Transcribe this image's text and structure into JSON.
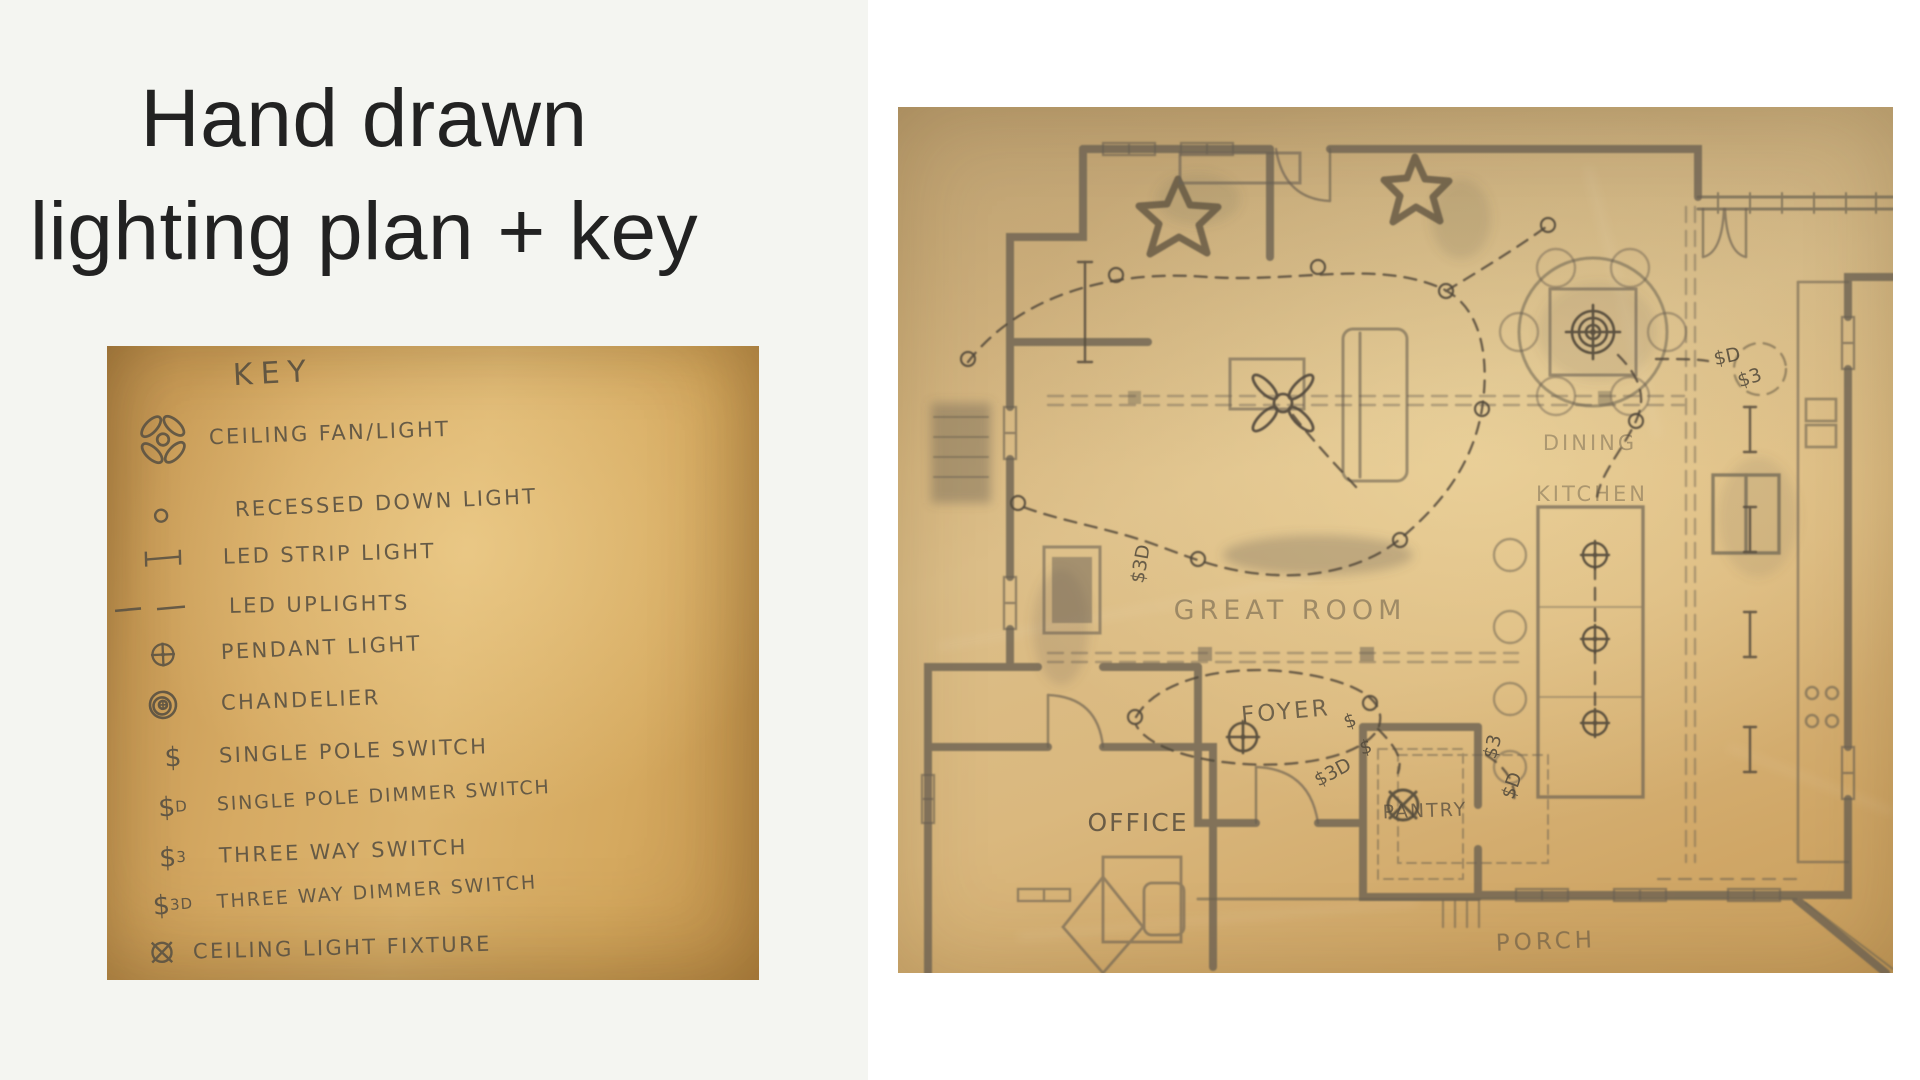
{
  "slide": {
    "title_line1": "Hand drawn",
    "title_line2": "lighting plan + key"
  },
  "key_card": {
    "heading": "KEY",
    "items": [
      {
        "icon": "ceiling-fan-icon",
        "label": "CEILING FAN/LIGHT"
      },
      {
        "icon": "recessed-down-light-icon",
        "label": "RECESSED DOWN LIGHT"
      },
      {
        "icon": "led-strip-light-icon",
        "label": "LED STRIP LIGHT"
      },
      {
        "icon": "led-uplights-icon",
        "label": "LED UPLIGHTS"
      },
      {
        "icon": "pendant-light-icon",
        "label": "PENDANT LIGHT"
      },
      {
        "icon": "chandelier-icon",
        "label": "CHANDELIER"
      },
      {
        "icon": "single-pole-switch-symbol",
        "glyph": "$",
        "sub": "",
        "label": "SINGLE POLE SWITCH"
      },
      {
        "icon": "single-pole-dimmer-symbol",
        "glyph": "$",
        "sub": "D",
        "label": "SINGLE POLE DIMMER SWITCH"
      },
      {
        "icon": "three-way-switch-symbol",
        "glyph": "$",
        "sub": "3",
        "label": "THREE WAY SWITCH"
      },
      {
        "icon": "three-way-dimmer-symbol",
        "glyph": "$",
        "sub": "3D",
        "label": "THREE WAY DIMMER SWITCH"
      },
      {
        "icon": "ceiling-light-fixture-icon",
        "label": "CEILING LIGHT FIXTURE"
      }
    ]
  },
  "floor_plan": {
    "rooms": {
      "dining": "DINING",
      "kitchen": "KITCHEN",
      "great_room": "GREAT ROOM",
      "foyer": "FOYER",
      "office": "OFFICE",
      "pantry": "PANTRY",
      "porch": "PORCH"
    },
    "switch_annotations": {
      "foyer_a": "$",
      "foyer_b": "$3D",
      "foyer_c": "$",
      "pantry_a": "$3",
      "pantry_b": "$D",
      "dining_a": "$D",
      "dining_b": "$3",
      "great_a": "$3D"
    }
  },
  "colors": {
    "left_panel_bg": "#f4f5f1",
    "right_bg": "#ffffff",
    "paper_tan": "#d6aa63",
    "plan_paper_tan": "#dcbe88",
    "pencil": "#5c5343",
    "title_text": "#222222"
  }
}
